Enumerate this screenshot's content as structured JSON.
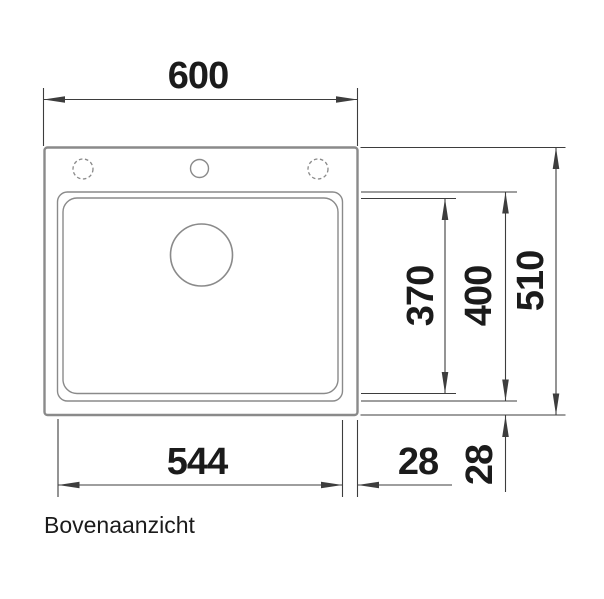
{
  "view": {
    "caption": "Bovenaanzicht"
  },
  "dimensions": {
    "total_width": "600",
    "total_depth": "510",
    "basin_depth": "400",
    "basin_inner_depth": "370",
    "basin_width": "544",
    "rim_right": "28",
    "rim_bottom": "28"
  },
  "colors": {
    "outline": "#8a8a8a",
    "dim": "#3d3d3d",
    "ink": "#1b1b1b",
    "bg": "#ffffff"
  }
}
